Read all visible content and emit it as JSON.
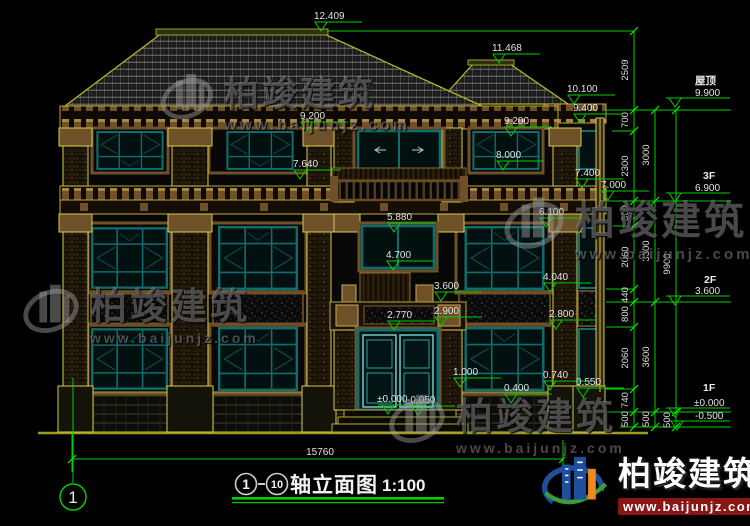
{
  "colors": {
    "annotation_green": "#00cf00",
    "window_teal": "#0e6e6e",
    "outline_olive": "#b9a83b",
    "masonry_brown": "#7a5a2c",
    "dim_text_white": "#e2e2e2",
    "logo_blue": "#1f4e9c",
    "logo_orange": "#f08a1e",
    "watermark_url_red": "#8a1515"
  },
  "markers": [
    {
      "v": "12.409"
    },
    {
      "v": "11.468"
    },
    {
      "v": "10.100"
    },
    {
      "v": "9.400"
    },
    {
      "v": "9.200"
    },
    {
      "v": "9.200"
    },
    {
      "v": "8.000"
    },
    {
      "v": "7.640"
    },
    {
      "v": "7.400"
    },
    {
      "v": "7.000"
    },
    {
      "v": "6.100"
    },
    {
      "v": "5.880"
    },
    {
      "v": "4.700"
    },
    {
      "v": "3.600"
    },
    {
      "v": "2.900"
    },
    {
      "v": "2.770"
    },
    {
      "v": "4.040"
    },
    {
      "v": "2.800"
    },
    {
      "v": "1.000"
    },
    {
      "v": "0.740"
    },
    {
      "v": "0.550"
    },
    {
      "v": "0.400"
    },
    {
      "v": "±0.000"
    },
    {
      "v": "-0.050"
    }
  ],
  "levels": {
    "roof_label": "屋顶",
    "roof_elev": "9.900",
    "f3_label": "3F",
    "f3_elev": "6.900",
    "f2_label": "2F",
    "f2_elev": "3.600",
    "f1_label": "1F",
    "f1_elev": "±0.000",
    "below_ground_elev": "-0.500"
  },
  "dims": {
    "col_inner": [
      "2509",
      "700",
      "2300",
      "800",
      "2060",
      "440",
      "800",
      "2060",
      "740",
      "500"
    ],
    "col_mid": [
      "3000",
      "3300",
      "3600",
      "500"
    ],
    "col_outer": [
      "9900",
      "500"
    ],
    "ground_total": "15760"
  },
  "title_bar": {
    "axis_start": "1",
    "axis_end": "10",
    "name": "轴立面图",
    "scale": "1:100"
  },
  "axis_bubble_label": "1",
  "watermark": {
    "brand": "柏竣建筑",
    "url": "www.baijunjz.com"
  }
}
